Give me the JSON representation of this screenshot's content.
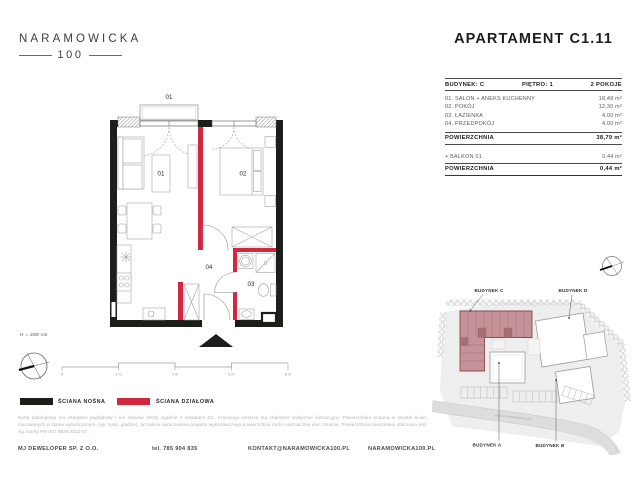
{
  "brand": {
    "name": "NARAMOWICKA",
    "number": "100"
  },
  "header": {
    "title": "APARTAMENT C1.11"
  },
  "spec": {
    "building": "BUDYNEK: C",
    "floor": "PIĘTRO: 1",
    "rooms": "2 POKOJE",
    "items": [
      {
        "label": "01. SALON + ANEKS KUCHENNY",
        "area": "18,49 m²"
      },
      {
        "label": "02. POKÓJ",
        "area": "12,30 m²"
      },
      {
        "label": "03. ŁAZIENKA",
        "area": "4,00 m²"
      },
      {
        "label": "04. PRZEDPOKÓJ",
        "area": "4,00 m²"
      }
    ],
    "total_label": "POWIERZCHNIA",
    "total_area": "38,79 m²",
    "balcony_label": "+ BALKON 01",
    "balcony_area": "0,44 m²",
    "balcony_total_label": "POWIERZCHNIA",
    "balcony_total_area": "0,44 m²"
  },
  "plan": {
    "balcony_tag": "01",
    "rooms": {
      "living": "01",
      "bedroom": "02",
      "bath": "03",
      "hall": "04"
    },
    "height_note": "H = 260 cm",
    "scale_labels": [
      "0",
      "2 m",
      "4 m",
      "6 m",
      "8 m"
    ]
  },
  "legend": {
    "load_bearing": {
      "label": "ŚCIANA NOŚNA",
      "color": "#1d1d1b"
    },
    "partition": {
      "label": "ŚCIANA DZIAŁOWA",
      "color": "#d2273e"
    }
  },
  "site": {
    "buildings": {
      "a": "BUDYNEK A",
      "b": "BUDYNEK B",
      "c": "BUDYNEK C",
      "d": "BUDYNEK D"
    },
    "street": "ULICA NARAMOWICKA"
  },
  "disclaimer": "Karta katalogowa ma charakter poglądowy i nie stanowi oferty zgodnie z zasadami KC. Aranżacja wnętrza ma charakter wyłącznie ilustracyjny. Powierzchnia podana w świetle ścian murowanych w stanie wykończonym, (np. tynki, gładzie). W trakcie opracowania projektu wykonawczego powierzchnia może nieznacznie ulec zmianie. Powierzchnia mieszkania obliczana jest wg normy PN-ISO 9836:2022-07.",
  "footer": {
    "company": "MJ DEWELOPER SP. Z O.O.",
    "phone": "tel. 785 904 835",
    "email": "KONTAKT@NARAMOWICKA100.PL",
    "website": "NARAMOWICKA100.PL"
  }
}
